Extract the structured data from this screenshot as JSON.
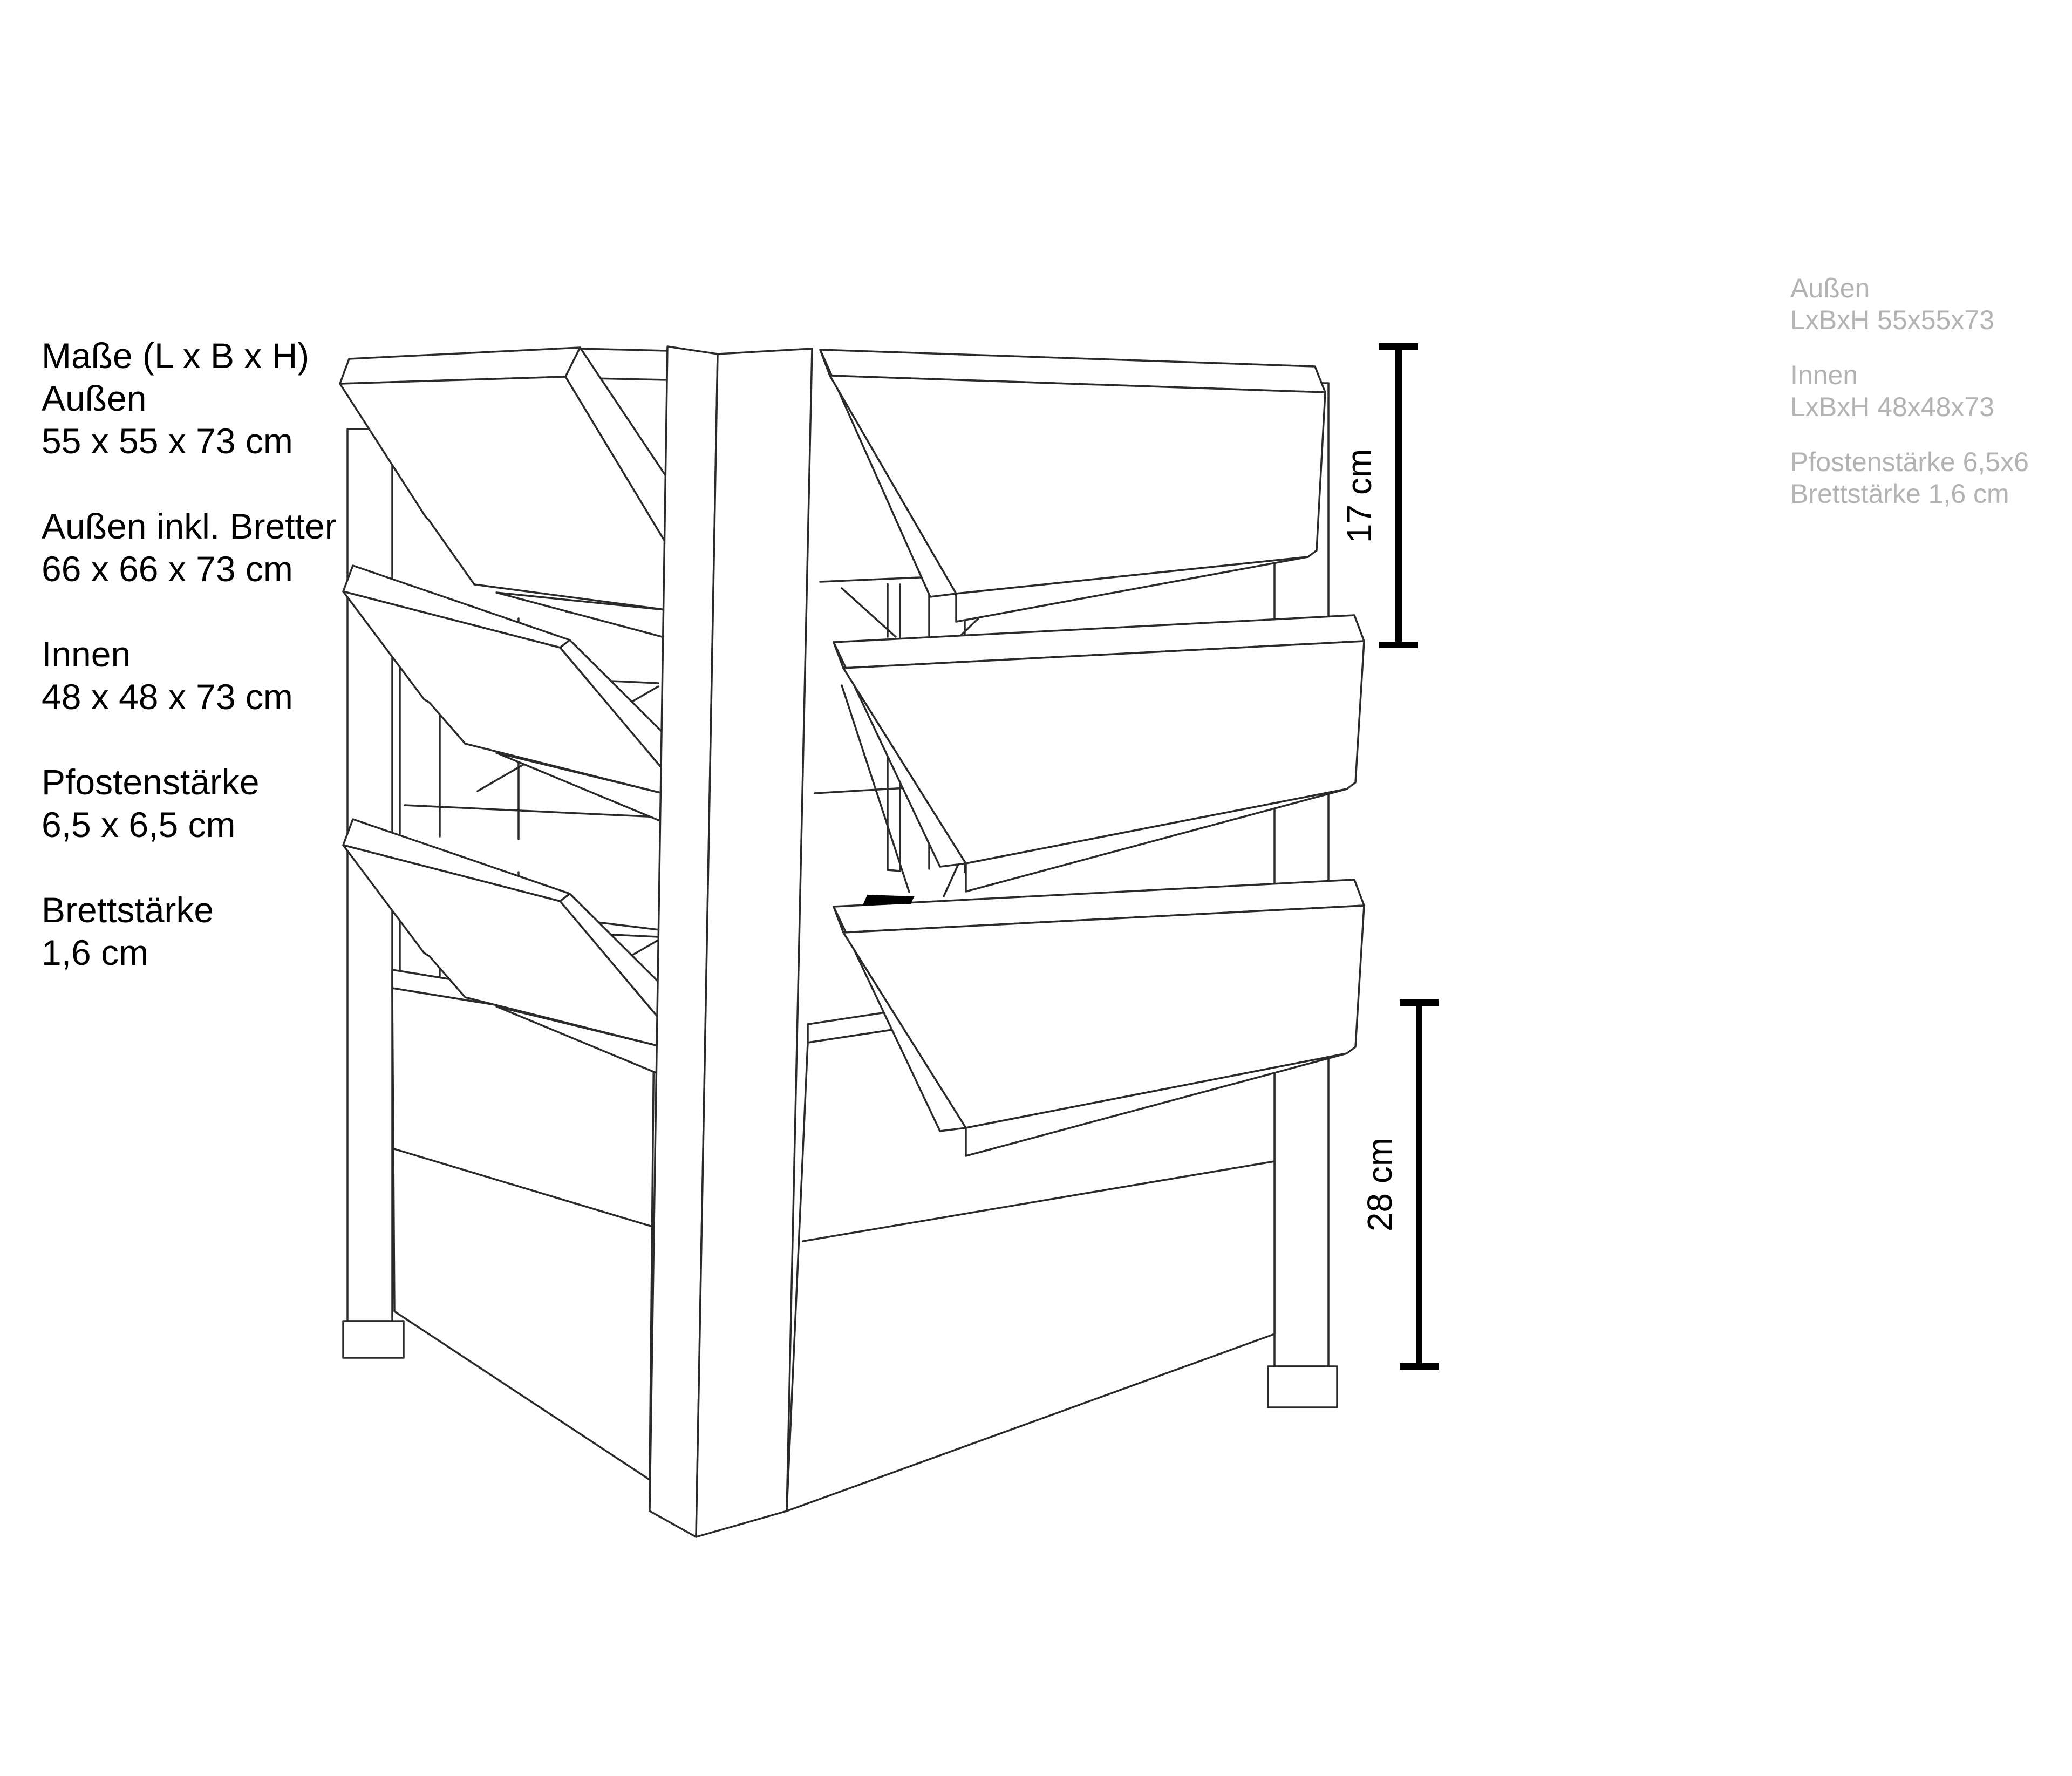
{
  "specs_left": {
    "groups": [
      {
        "lines": [
          "Maße (L x B x H)",
          "Außen",
          "55 x 55 x 73 cm"
        ]
      },
      {
        "lines": [
          "Außen inkl. Bretter",
          "66 x 66 x 73 cm"
        ]
      },
      {
        "lines": [
          "Innen",
          "48 x 48 x 73 cm"
        ]
      },
      {
        "lines": [
          "Pfostenstärke",
          "6,5 x 6,5 cm"
        ]
      },
      {
        "lines": [
          "Brettstärke",
          "1,6 cm"
        ]
      }
    ]
  },
  "specs_right": {
    "groups": [
      {
        "lines": [
          "Außen",
          "LxBxH 55x55x73"
        ]
      },
      {
        "lines": [
          "Innen",
          "LxBxH 48x48x73"
        ]
      },
      {
        "lines": [
          "Pfostenstärke 6,5x6",
          "Brettstärke 1,6 cm"
        ]
      }
    ]
  },
  "dimensions": {
    "upper_label": "17 cm",
    "lower_label": "28 cm"
  },
  "colors": {
    "background": "#ffffff",
    "text": "#000000",
    "muted_text": "#b3b3b3",
    "line_ink": "#2a2a2a"
  }
}
